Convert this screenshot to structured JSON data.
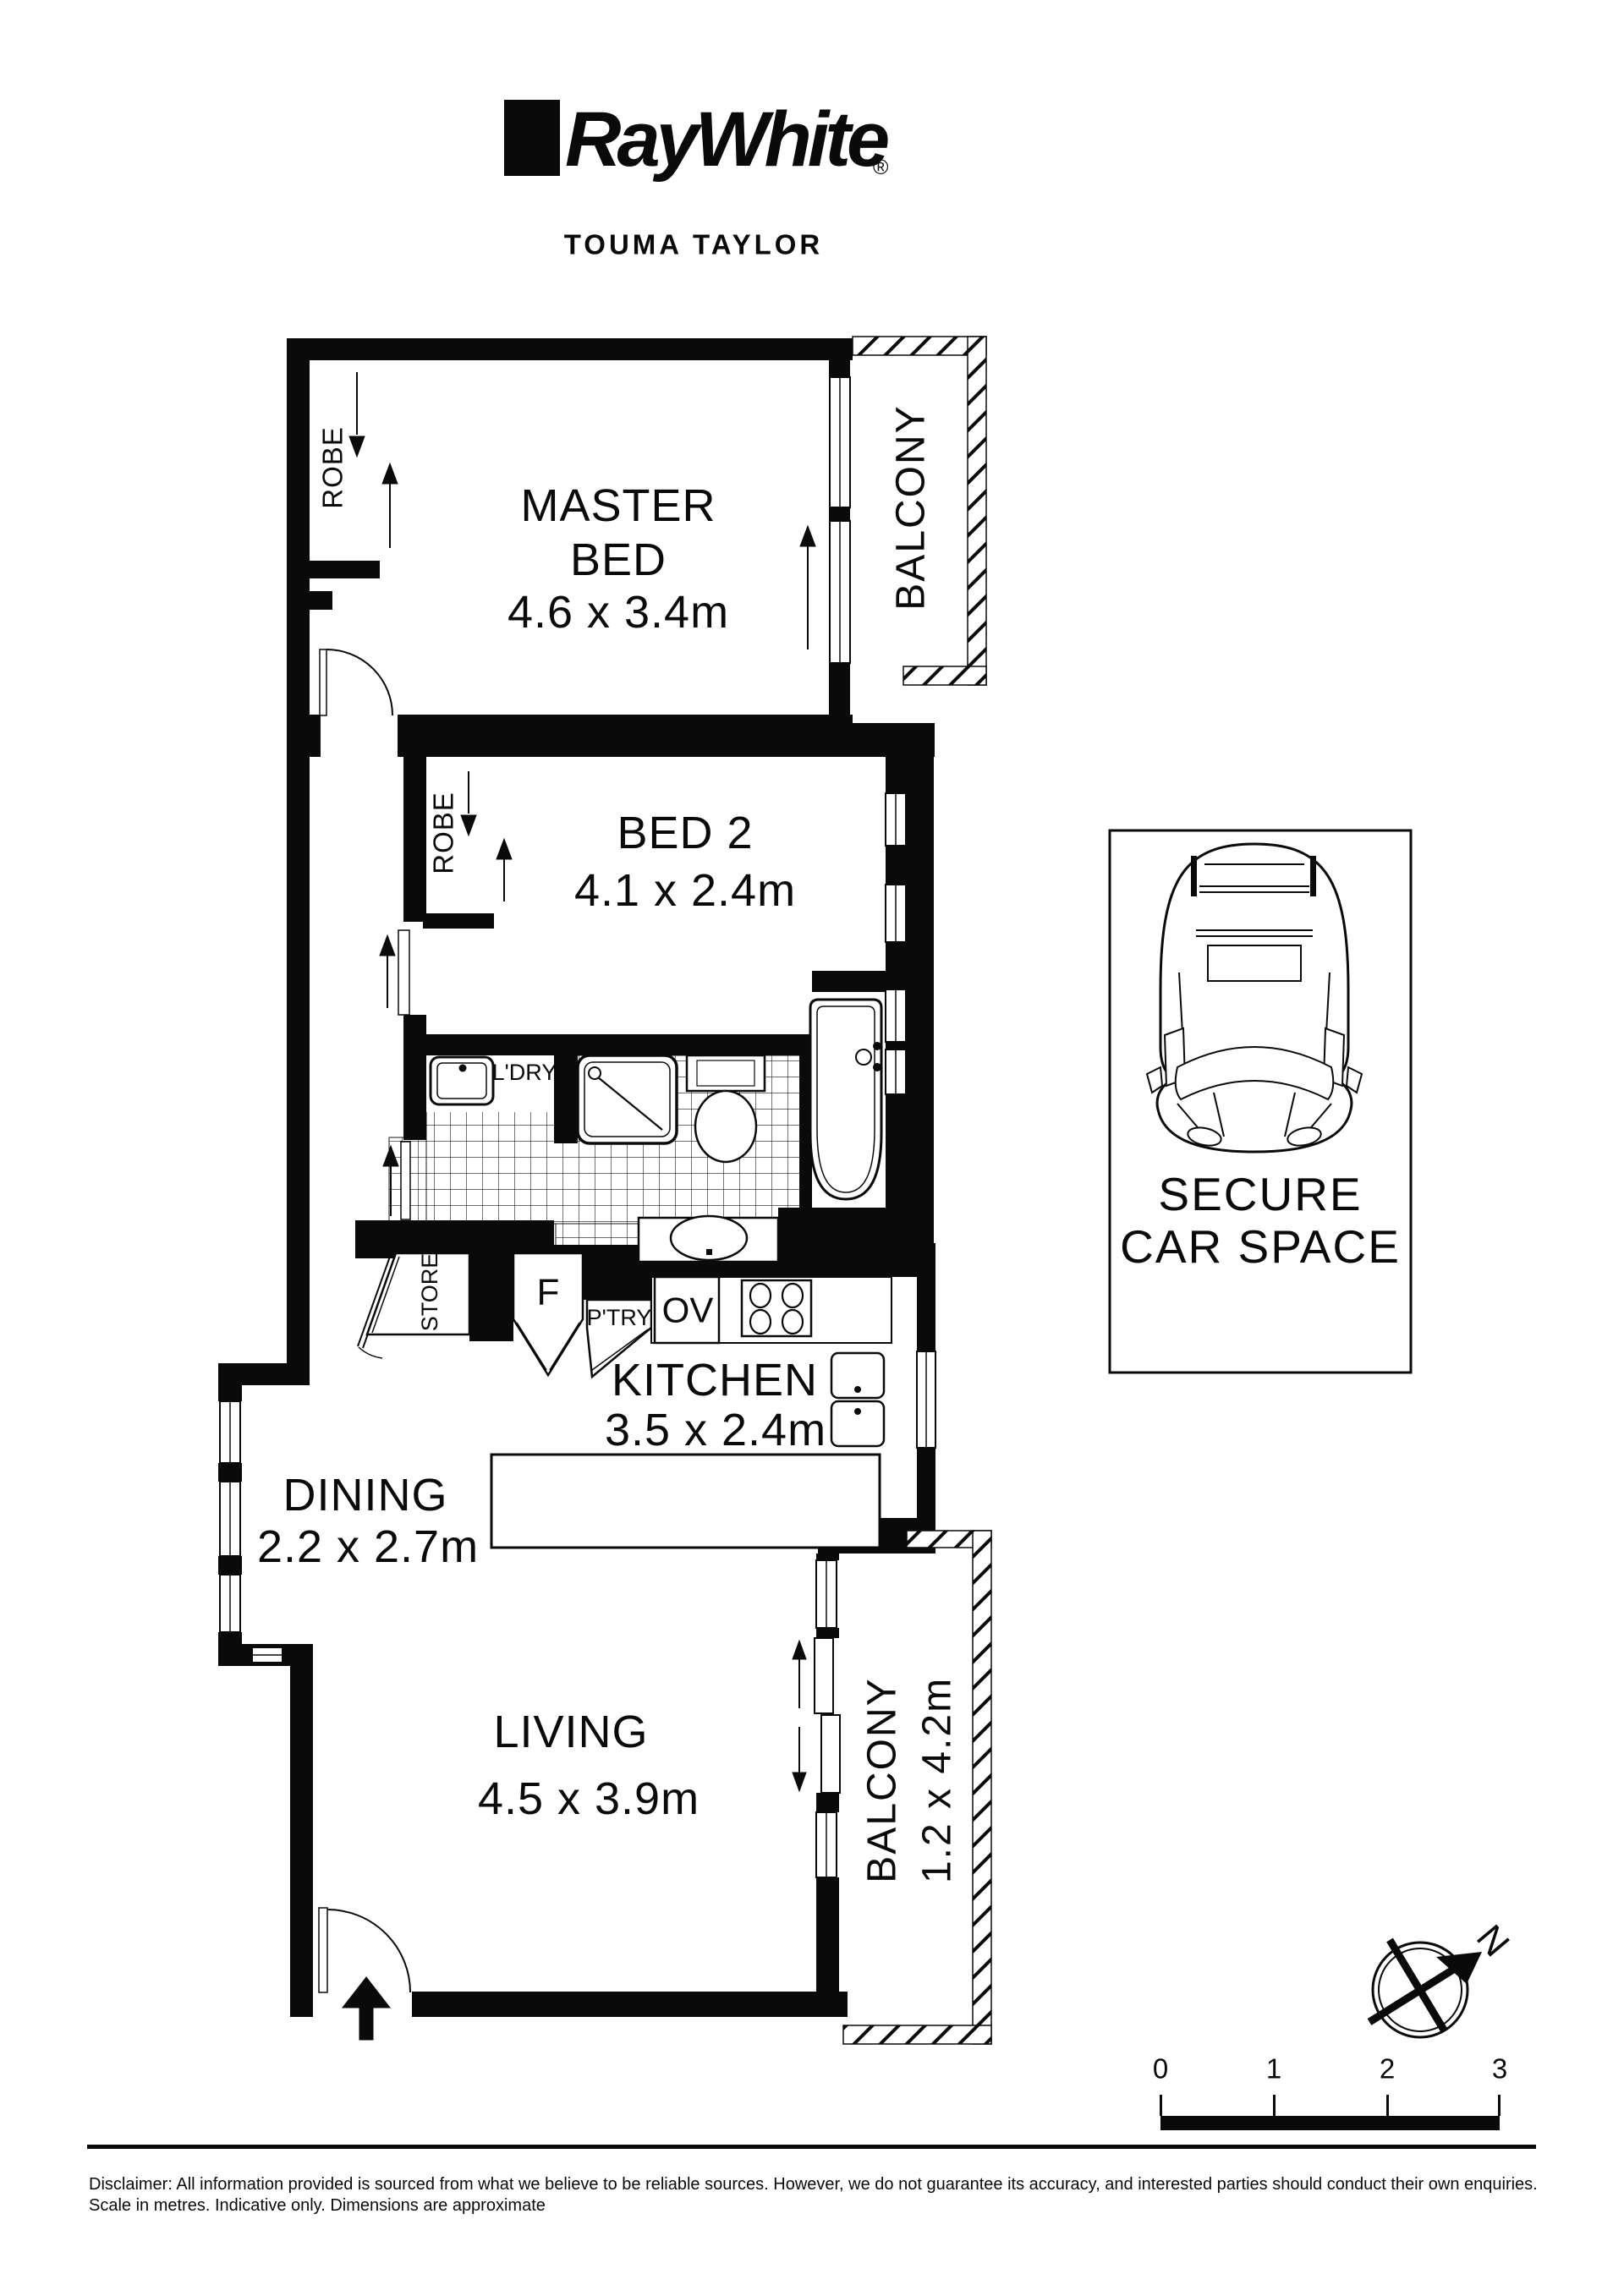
{
  "header": {
    "brand": "RayWhite",
    "registered": "®",
    "agency": "TOUMA TAYLOR"
  },
  "rooms": {
    "master": {
      "line1": "MASTER",
      "line2": "BED",
      "dims": "4.6 x 3.4m"
    },
    "bed2": {
      "name": "BED 2",
      "dims": "4.1 x 2.4m"
    },
    "kitchen": {
      "name": "KITCHEN",
      "dims": "3.5 x 2.4m"
    },
    "dining": {
      "name": "DINING",
      "dims": "2.2 x 2.7m"
    },
    "living": {
      "name": "LIVING",
      "dims": "4.5 x 3.9m"
    },
    "balcony_top": {
      "name": "BALCONY"
    },
    "balcony_bottom": {
      "name": "BALCONY",
      "dims": "1.2 x 4.2m"
    }
  },
  "features": {
    "robe_master": "ROBE",
    "robe_bed2": "ROBE",
    "laundry": "L'DRY",
    "store": "STORE",
    "fridge": "F",
    "pantry": "P'TRY",
    "oven": "OV"
  },
  "car_space": {
    "line1": "SECURE",
    "line2": "CAR SPACE"
  },
  "compass": {
    "north": "N"
  },
  "scale_bar": {
    "labels": [
      "0",
      "1",
      "2",
      "3"
    ]
  },
  "footer": {
    "disclaimer_line1": "Disclaimer: All information provided is sourced from what we believe to be reliable sources. However, we do not guarantee  its accuracy, and interested parties should conduct their own enquiries.",
    "disclaimer_line2": "Scale in metres. Indicative only. Dimensions are approximate"
  }
}
